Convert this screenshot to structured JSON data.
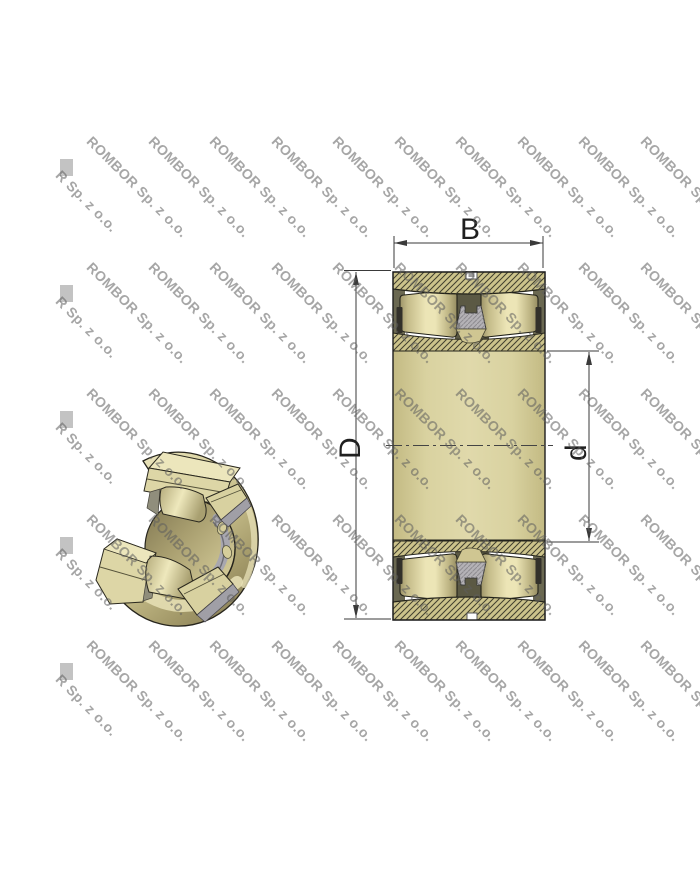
{
  "watermark": {
    "text": "ROMBOR Sp. z o.o.",
    "partial_text": "R Sp. z o.o.",
    "rotation_deg": 45,
    "color": "#5e5e5e",
    "opacity": 0.55,
    "rows_y": [
      133,
      259,
      385,
      511,
      637
    ],
    "cols_x": [
      95,
      156.5,
      218,
      279.5,
      341,
      402.5,
      464,
      525.5,
      587,
      648.5
    ],
    "partial_col_x": 64,
    "partial_offset_y": 34
  },
  "section_view": {
    "dimension_labels": {
      "width": "B",
      "outer_diameter": "D",
      "bore_diameter": "d"
    }
  },
  "colors": {
    "ring_tan": "#ccc38b",
    "hatch_line": "#413f2e",
    "roller_light": "#ece5b6",
    "roller_dark": "#9e9569",
    "inner_block_tan": "#d9d2a0",
    "gap_dark": "#5b5944",
    "cage_gray": "#b4b2b6",
    "cage_hatch": "#8d8b90",
    "dimension_line": "#3a3a3a",
    "outline": "#1e1e1e"
  }
}
